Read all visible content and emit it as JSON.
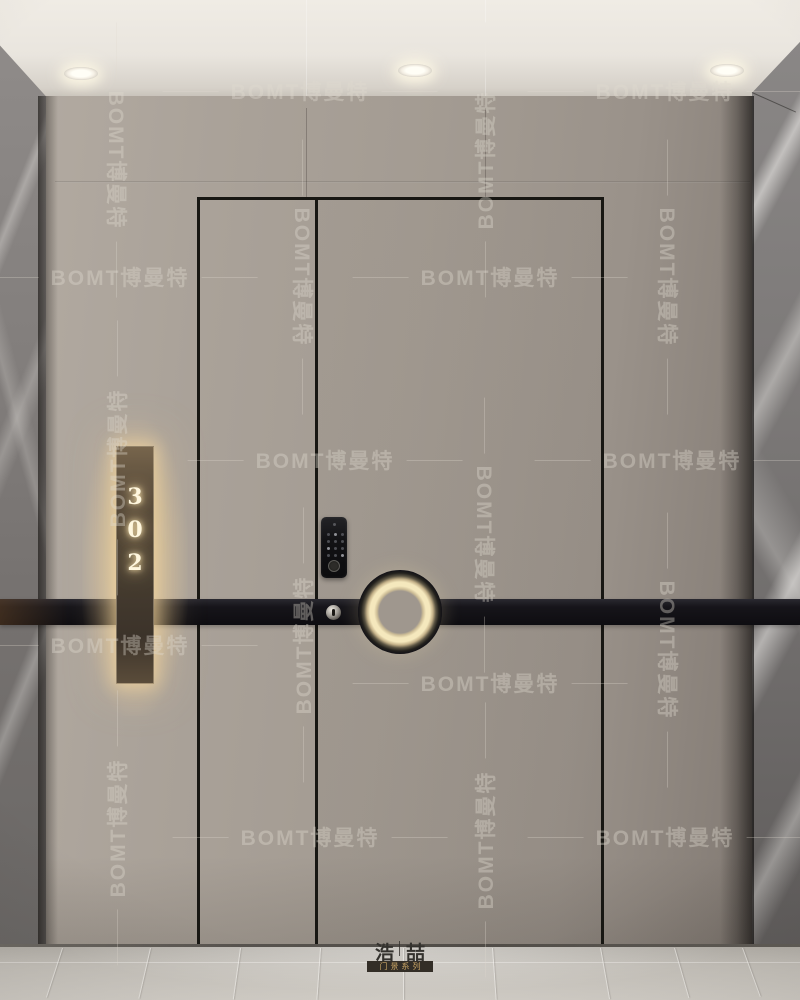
{
  "watermark": {
    "text": "BOMT博曼特"
  },
  "door_sign": {
    "number": "302"
  },
  "logo": {
    "name": "浩喆",
    "series_label": "门景系列"
  },
  "colors": {
    "wall_taupe": "#a39b92",
    "belt_band_black": "#121116",
    "sign_glow": "#ffe0a6",
    "sign_panel_bronze": "#4a3f31",
    "ceiling": "#e9e5de",
    "marble_gray": "#7b7877",
    "floor_marble": "#ccc8c1",
    "logo_gold": "#c9a565"
  }
}
